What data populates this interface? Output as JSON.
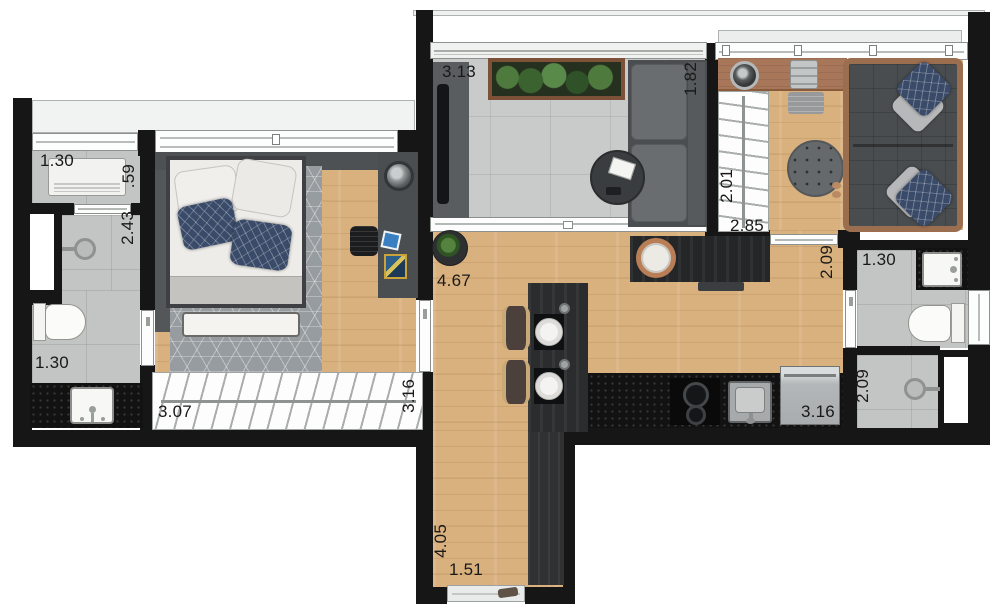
{
  "labels": {
    "utility_width": "1.30",
    "utility_depth": ".59",
    "shower_depth": "2.43",
    "bath1_width": "1.30",
    "bedroom_width": "3.07",
    "bedroom_depth": "3.16",
    "balcony_width": "3.13",
    "balcony_depth": "1.82",
    "living_width": "4.67",
    "suite_closet_depth": "2.01",
    "suite_width": "2.85",
    "living_depth": "2.09",
    "bath2_width": "1.30",
    "kitchen_width": "3.16",
    "bath2_shower_depth": "2.09",
    "hall_depth": "4.05",
    "hall_width": "1.51"
  },
  "colors": {
    "wall": "#161616",
    "wood_floor": "#d9b17e",
    "bath_tile": "#c2c5c3",
    "balcony_tile": "#c8cbc9",
    "counter": "#121212",
    "frame_wood": "#9c6e50",
    "label_text": "#191919"
  }
}
